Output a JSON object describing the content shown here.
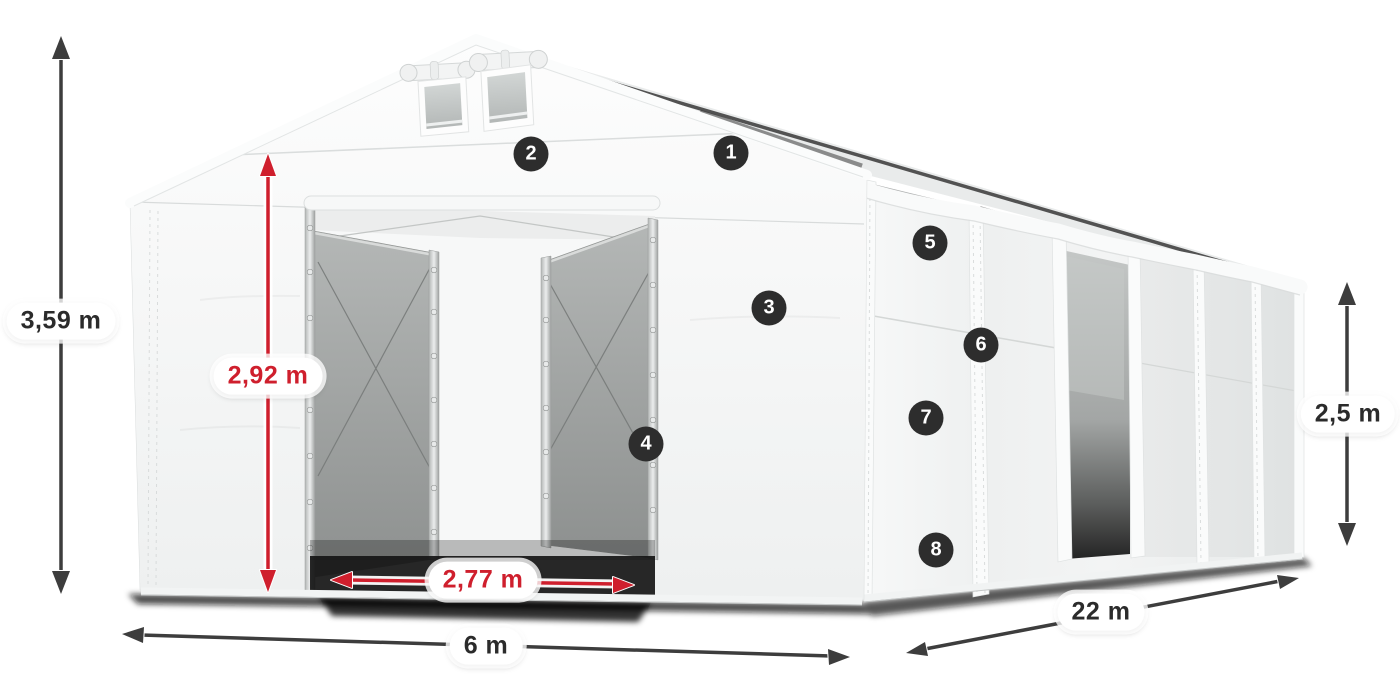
{
  "diagram": {
    "dimensions": [
      {
        "id": "total-height",
        "label": "3,59 m",
        "style": "dark"
      },
      {
        "id": "entrance-height",
        "label": "2,92 m",
        "style": "red"
      },
      {
        "id": "entrance-width",
        "label": "2,77 m",
        "style": "red"
      },
      {
        "id": "width",
        "label": "6 m",
        "style": "dark"
      },
      {
        "id": "length",
        "label": "22 m",
        "style": "dark"
      },
      {
        "id": "side-height",
        "label": "2,5 m",
        "style": "dark"
      }
    ],
    "callouts": [
      {
        "number": "1"
      },
      {
        "number": "2"
      },
      {
        "number": "3"
      },
      {
        "number": "4"
      },
      {
        "number": "5"
      },
      {
        "number": "6"
      },
      {
        "number": "7"
      },
      {
        "number": "8"
      }
    ],
    "colors": {
      "arrow_dark": "#3d3d3d",
      "arrow_red": "#cf1f2d",
      "badge_bg": "#2d2d2d",
      "badge_text": "#ffffff",
      "pill_bg": "#ffffff",
      "pill_text_dark": "#2b2b2b",
      "fabric_white": "#f4f5f5",
      "interior_gray": "#9c9f9e"
    }
  }
}
